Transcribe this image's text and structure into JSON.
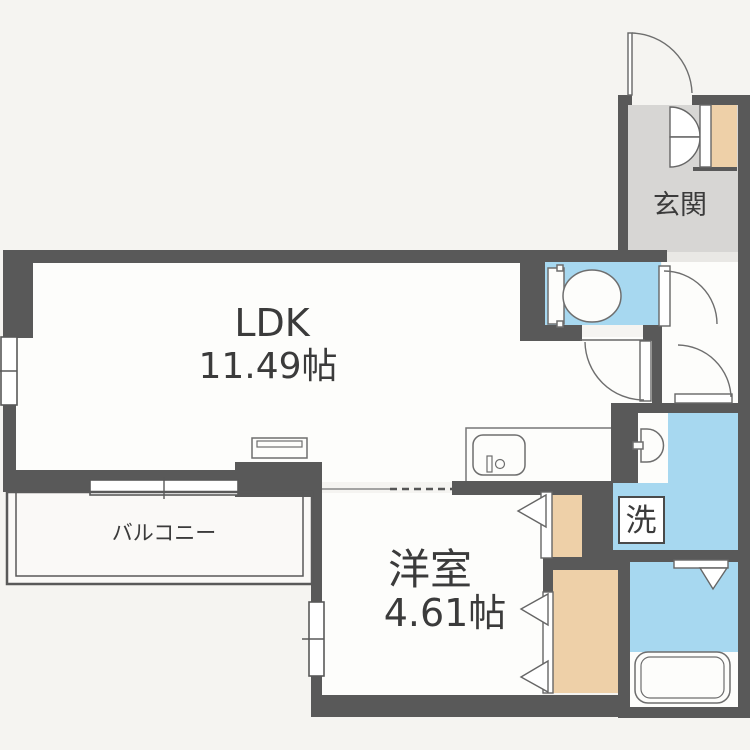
{
  "floorplan": {
    "rooms": {
      "ldk": {
        "label": "LDK",
        "area": "11.49帖"
      },
      "bedroom": {
        "label": "洋室",
        "area": "4.61帖"
      },
      "balcony": {
        "label": "バルコニー"
      },
      "entrance": {
        "label": "玄関"
      },
      "laundry": {
        "label": "洗"
      }
    },
    "fixtures": {
      "toilet": "toilet-icon",
      "bathtub": "bathtub-icon",
      "kitchen_sink": "kitchen-sink-icon",
      "washbasin": "washbasin-icon",
      "stove": "stove-icon",
      "washer_box": "washing-machine-box"
    },
    "colors": {
      "bg": "#f5f4f1",
      "floor": "#fdfdfb",
      "water": "#a7d8f0",
      "closet": "#eed0a8",
      "genkan": "#d7d6d4",
      "step": "#e9e8e5",
      "balc": "#faf9f7",
      "wall": "#595959",
      "line": "#6e6e6e",
      "text": "#3b3b3b"
    }
  }
}
